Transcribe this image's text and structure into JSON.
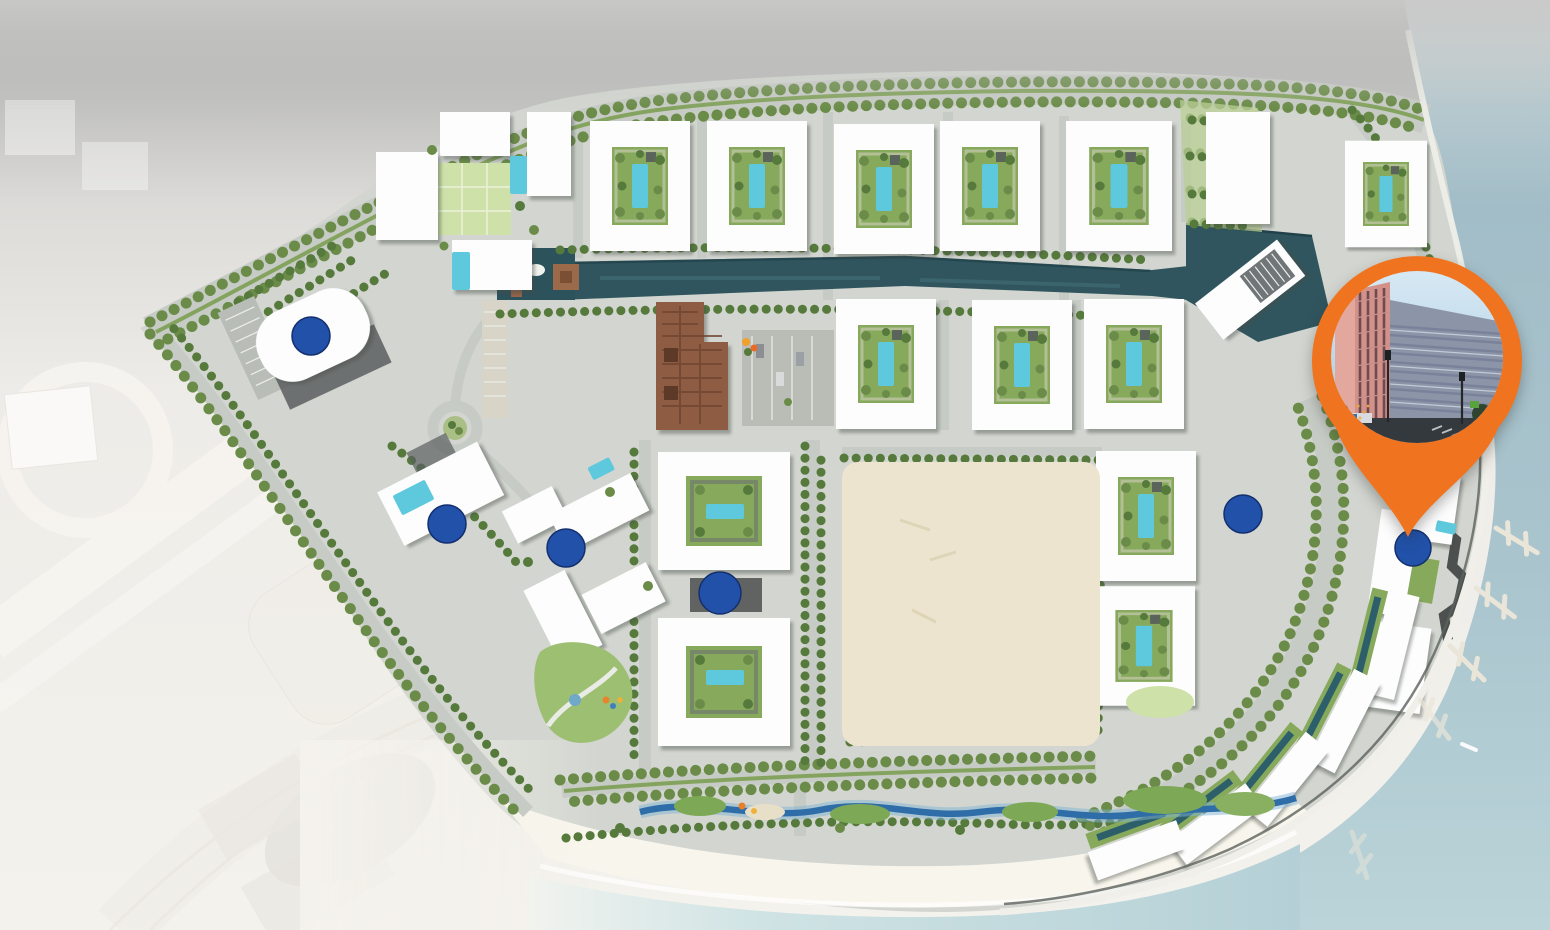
{
  "scene": {
    "kind": "aerial-master-plan-rendering",
    "marker_count_blue": 6,
    "pin": {
      "shape": "map-pin-marker",
      "photo_subject": "street-level view of pink and blue-gray apartment buildings"
    },
    "features": [
      {
        "name": "tree-lined-boulevard",
        "kind": "road"
      },
      {
        "name": "residential-courtyard-blocks",
        "kind": "buildings"
      },
      {
        "name": "central-canal",
        "kind": "water"
      },
      {
        "name": "marina-basin",
        "kind": "water"
      },
      {
        "name": "open-sand-lot",
        "kind": "ground"
      },
      {
        "name": "beach-with-stream",
        "kind": "shore"
      },
      {
        "name": "waterfront-crescent-buildings",
        "kind": "buildings"
      },
      {
        "name": "boat-piers",
        "kind": "marine"
      },
      {
        "name": "roundabout",
        "kind": "road"
      },
      {
        "name": "highway-interchange-faded",
        "kind": "context"
      }
    ]
  },
  "colors": {
    "backdrop_top": "#a7a7a7",
    "backdrop_mid": "#dcdbd8",
    "surroundings": "#f4f2ec",
    "site_ground": "#d3d6d0",
    "road_gray": "#c7cbc5",
    "building_white": "#fdfdfe",
    "tree_green": "#6b8c49",
    "tree_dark": "#567a3c",
    "hedge_green": "#7c9e52",
    "lawn_green": "#cde1a8",
    "courtyard_green": "#86a95c",
    "pool_teal": "#5ec8dd",
    "pool_dark": "#2d5f6b",
    "canal_teal": "#30555e",
    "sand_lot": "#ece4cf",
    "beach_sand": "#f8f5ec",
    "sea_right": "#9fbac4",
    "sea_shallow": "#c2dce0",
    "marker_navy": "#2151a8",
    "marker_navy_edge": "#142f6e",
    "pin_orange": "#f0741f",
    "pier_tan": "#e9e5d8",
    "brown_building": "#8d5c42",
    "photo_sky": "#cfe6f2",
    "photo_pink": "#d4918a",
    "photo_gray_blue": "#8c94a7",
    "photo_street": "#34393e"
  }
}
